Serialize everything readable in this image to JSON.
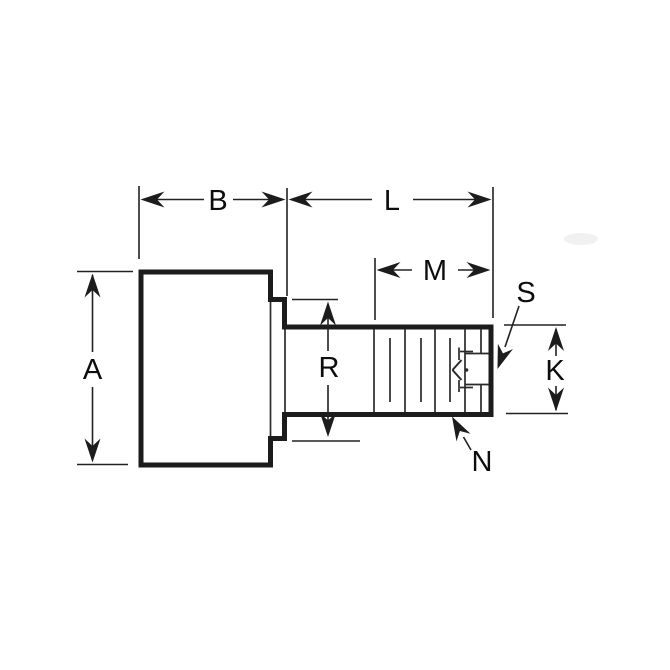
{
  "diagram": {
    "background_color": "#ffffff",
    "line_color": "#1c1c1c",
    "description": "Side-view engineering dimension drawing of a shouldered fastener: large head, collar step, plain shoulder, threaded end with hidden internal socket detail",
    "dimensions": [
      {
        "label": "A",
        "kind": "vertical-linear"
      },
      {
        "label": "B",
        "kind": "horizontal-linear"
      },
      {
        "label": "L",
        "kind": "horizontal-linear"
      },
      {
        "label": "M",
        "kind": "horizontal-linear"
      },
      {
        "label": "R",
        "kind": "vertical-linear"
      },
      {
        "label": "K",
        "kind": "vertical-linear"
      },
      {
        "label": "S",
        "kind": "leader-callout"
      },
      {
        "label": "N",
        "kind": "leader-callout"
      }
    ]
  }
}
